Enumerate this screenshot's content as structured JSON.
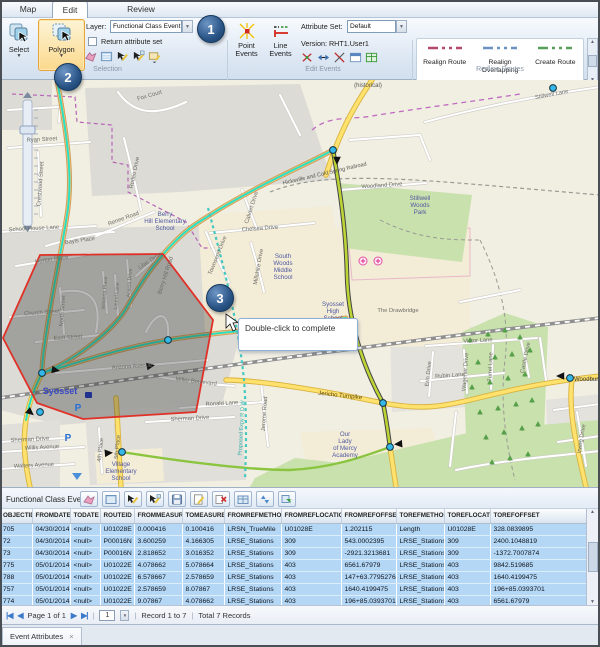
{
  "ribbon": {
    "tabs": [
      {
        "label": "Map"
      },
      {
        "label": "Edit"
      },
      {
        "label": "Review"
      }
    ],
    "select_label": "Select",
    "polygon_label": "Polygon",
    "layer_label": "Layer:",
    "layer_value": "Functional Class Event",
    "return_attribute_set": "Return attribute set",
    "selection_group": "Selection",
    "point_events_label": "Point Events",
    "line_events_label": "Line Events",
    "attribute_set_label": "Attribute Set:",
    "attribute_set_value": "Default",
    "version_text": "Version: RHT1.User1",
    "edit_events_group": "Edit Events",
    "redline_buttons": [
      "Realign Route",
      "Realign Overlapping",
      "Create Route"
    ],
    "redline_group": "Redline Routes"
  },
  "callouts": [
    "1",
    "2",
    "3"
  ],
  "map": {
    "tooltip": "Double-click to complete",
    "labels": [
      {
        "t": "Fox Court",
        "x": 150,
        "y": 17,
        "r": -16
      },
      {
        "t": "Ryan Street",
        "x": 42,
        "y": 61,
        "r": -3
      },
      {
        "t": "Crestwood Street",
        "x": 42,
        "y": 104,
        "r": -86
      },
      {
        "t": "School House Lane",
        "x": 34,
        "y": 150,
        "r": -3
      },
      {
        "t": "Bayls Place",
        "x": 80,
        "y": 162,
        "r": -8
      },
      {
        "t": "Rodeo Drive",
        "x": 136,
        "y": 93,
        "r": -78
      },
      {
        "t": "Renee Road",
        "x": 124,
        "y": 140,
        "r": -20
      },
      {
        "t": "Woodland Drive",
        "x": 382,
        "y": 107,
        "r": -4
      },
      {
        "t": "Stillwell Lane",
        "x": 552,
        "y": 16,
        "r": -11
      },
      {
        "t": "Chelsea Drive",
        "x": 260,
        "y": 150,
        "r": -4
      },
      {
        "t": "Calvert Drive",
        "x": 253,
        "y": 128,
        "r": -72
      },
      {
        "t": "Townsend Drive",
        "x": 219,
        "y": 176,
        "r": -68
      },
      {
        "t": "Millshire Drive",
        "x": 260,
        "y": 187,
        "r": -80
      },
      {
        "t": "Victor Lane",
        "x": 478,
        "y": 262,
        "r": -3
      },
      {
        "t": "Rubin Lane",
        "x": 450,
        "y": 297,
        "r": -4
      },
      {
        "t": "Erin Drive",
        "x": 430,
        "y": 294,
        "r": -84
      },
      {
        "t": "Wagener Drive",
        "x": 467,
        "y": 292,
        "r": -86
      },
      {
        "t": "Turrel Lane",
        "x": 492,
        "y": 287,
        "r": -88
      },
      {
        "t": "Castle Drive",
        "x": 527,
        "y": 278,
        "r": -78
      },
      {
        "t": "Irving Drive",
        "x": 583,
        "y": 359,
        "r": -80
      },
      {
        "t": "Arizona Avenue",
        "x": 132,
        "y": 288,
        "r": -4
      },
      {
        "t": "Miller Boulevard",
        "x": 196,
        "y": 303,
        "r": 7
      },
      {
        "t": "Ronald Lane",
        "x": 222,
        "y": 325,
        "r": -3
      },
      {
        "t": "Jerome Road",
        "x": 266,
        "y": 334,
        "r": -86
      },
      {
        "t": "Sherman Drive",
        "x": 30,
        "y": 361,
        "r": -3
      },
      {
        "t": "Sherman Drive",
        "x": 190,
        "y": 340,
        "r": -3
      },
      {
        "t": "Willis Avenue",
        "x": 42,
        "y": 369,
        "r": -3
      },
      {
        "t": "Walters Avenue",
        "x": 34,
        "y": 387,
        "r": -3
      },
      {
        "t": "4th Place",
        "x": 102,
        "y": 370,
        "r": -84
      },
      {
        "t": "5th Place",
        "x": 119,
        "y": 367,
        "r": -84
      },
      {
        "t": "Horton Place",
        "x": 52,
        "y": 181,
        "r": -8
      },
      {
        "t": "Church Street",
        "x": 42,
        "y": 234,
        "r": -4
      },
      {
        "t": "North Street",
        "x": 64,
        "y": 231,
        "r": -86
      },
      {
        "t": "East Street",
        "x": 68,
        "y": 259,
        "r": -4
      },
      {
        "t": "Wisteria Place",
        "x": 106,
        "y": 213,
        "r": -86,
        "s": 5.2
      },
      {
        "t": "Laurel Lane",
        "x": 118,
        "y": 216,
        "r": -86,
        "s": 5.2
      },
      {
        "t": "Acacia Drive",
        "x": 131,
        "y": 203,
        "r": -86,
        "s": 5.2
      },
      {
        "t": "Lilac Drive",
        "x": 151,
        "y": 182,
        "r": -33
      },
      {
        "t": "Berry Hill Road",
        "x": 167,
        "y": 196,
        "r": -72
      },
      {
        "t": "Jericho Turnpike",
        "x": 340,
        "y": 317,
        "r": 6,
        "c": "#5a4a10",
        "s": 6
      },
      {
        "t": "The Drawbridge",
        "x": 398,
        "y": 232
      },
      {
        "t": "Proposed Expy R O W",
        "x": 243,
        "y": 348,
        "r": -87,
        "c": "#3bb0aa",
        "s": 5.5
      },
      {
        "t": "Hicksville and Cold Spring Railroad",
        "x": 325,
        "y": 95,
        "r": -13,
        "c": "#55554f",
        "s": 5.5
      },
      {
        "t": "(historical)",
        "x": 368,
        "y": 7,
        "c": "#55554f",
        "s": 6
      },
      {
        "t": "Berry",
        "x": 165,
        "y": 136,
        "c": "#5059a0",
        "s": 6.2
      },
      {
        "t": "Hill Elementary",
        "x": 165,
        "y": 143,
        "c": "#5059a0",
        "s": 6.2
      },
      {
        "t": "School",
        "x": 165,
        "y": 150,
        "c": "#5059a0",
        "s": 6.2
      },
      {
        "t": "South",
        "x": 283,
        "y": 178,
        "c": "#5059a0",
        "s": 6.2
      },
      {
        "t": "Woods",
        "x": 283,
        "y": 185,
        "c": "#5059a0",
        "s": 6.2
      },
      {
        "t": "Middle",
        "x": 283,
        "y": 192,
        "c": "#5059a0",
        "s": 6.2
      },
      {
        "t": "School",
        "x": 283,
        "y": 199,
        "c": "#5059a0",
        "s": 6.2
      },
      {
        "t": "Syosset",
        "x": 333,
        "y": 226,
        "c": "#5059a0",
        "s": 6.2
      },
      {
        "t": "High",
        "x": 333,
        "y": 233,
        "c": "#5059a0",
        "s": 6.2
      },
      {
        "t": "School",
        "x": 333,
        "y": 240,
        "c": "#5059a0",
        "s": 6.2
      },
      {
        "t": "Stillwell",
        "x": 420,
        "y": 120,
        "c": "#5059a0",
        "s": 6.2
      },
      {
        "t": "Woods",
        "x": 420,
        "y": 127,
        "c": "#5059a0",
        "s": 6.2
      },
      {
        "t": "Park",
        "x": 420,
        "y": 134,
        "c": "#5059a0",
        "s": 6.2
      },
      {
        "t": "Our",
        "x": 345,
        "y": 356,
        "c": "#5059a0",
        "s": 6.2
      },
      {
        "t": "Lady",
        "x": 345,
        "y": 363,
        "c": "#5059a0",
        "s": 6.2
      },
      {
        "t": "of Mercy",
        "x": 345,
        "y": 370,
        "c": "#5059a0",
        "s": 6.2
      },
      {
        "t": "Academy",
        "x": 345,
        "y": 377,
        "c": "#5059a0",
        "s": 6.2
      },
      {
        "t": "Village",
        "x": 121,
        "y": 386,
        "c": "#5059a0",
        "s": 6.2
      },
      {
        "t": "Elementary",
        "x": 121,
        "y": 393,
        "c": "#5059a0",
        "s": 6.2
      },
      {
        "t": "School",
        "x": 121,
        "y": 400,
        "c": "#5059a0",
        "s": 6.2
      },
      {
        "t": "Syosset",
        "x": 60,
        "y": 314,
        "c": "#3a49c4",
        "s": 9,
        "w": "bold"
      },
      {
        "t": "Woodbury",
        "x": 574,
        "y": 301,
        "c": "#333333",
        "s": 6,
        "a": "start"
      },
      {
        "t": "P",
        "x": 78,
        "y": 331,
        "c": "#2a6fd4",
        "s": 10,
        "w": "bold"
      },
      {
        "t": "P",
        "x": 68,
        "y": 361,
        "c": "#2a6fd4",
        "s": 10,
        "w": "bold"
      }
    ]
  },
  "table": {
    "title": "Functional Class Event",
    "columns": [
      "OBJECTID",
      "FROMDATE",
      "TODATE",
      "ROUTEID",
      "FROMMEASURE",
      "TOMEASURE",
      "FROMREFMETHOD",
      "FROMREFLOCATION",
      "FROMREFOFFSET",
      "TOREFMETHOD",
      "TOREFLOCATION",
      "TOREFOFFSET"
    ],
    "rows": [
      [
        "705",
        "04/30/2014",
        "<null>",
        "U01028E",
        "0.000416",
        "0.100416",
        "LRSN_TrueMile",
        "U01028E",
        "1.202115",
        "Length",
        "U01028E",
        "328.0839895"
      ],
      [
        "72",
        "04/30/2014",
        "<null>",
        "P00016N",
        "3.600259",
        "4.166305",
        "LRSE_Stations",
        "309",
        "543.0002395",
        "LRSE_Stations",
        "309",
        "2400.1048819"
      ],
      [
        "73",
        "04/30/2014",
        "<null>",
        "P00016N",
        "2.818652",
        "3.016352",
        "LRSE_Stations",
        "309",
        "-2921.3213681",
        "LRSE_Stations",
        "309",
        "-1372.7007874"
      ],
      [
        "775",
        "05/01/2014",
        "<null>",
        "U01022E",
        "4.078662",
        "5.078664",
        "LRSE_Stations",
        "403",
        "6561.67979",
        "LRSE_Stations",
        "403",
        "9842.519685"
      ],
      [
        "788",
        "05/01/2014",
        "<null>",
        "U01022E",
        "6.578667",
        "2.578659",
        "LRSE_Stations",
        "403",
        "147+63.7795276",
        "LRSE_Stations",
        "403",
        "1640.4199475"
      ],
      [
        "757",
        "05/01/2014",
        "<null>",
        "U01022E",
        "2.578659",
        "8.07867",
        "LRSE_Stations",
        "403",
        "1640.4199475",
        "LRSE_Stations",
        "403",
        "196+85.0393701"
      ],
      [
        "774",
        "05/01/2014",
        "<null>",
        "U01022E",
        "9.07867",
        "4.078662",
        "LRSE_Stations",
        "403",
        "196+85.0393701",
        "LRSE_Stations",
        "403",
        "6561.67979"
      ]
    ],
    "pagination": {
      "first": "|◀",
      "prev": "◀",
      "page": "Page 1 of 1",
      "next": "▶",
      "last": "▶|",
      "sep": "|",
      "page_number": "1",
      "record": "Record 1 to 7",
      "total": "Total 7 Records"
    }
  },
  "bottom_tab": {
    "label": "Event Attributes",
    "close": "×"
  }
}
